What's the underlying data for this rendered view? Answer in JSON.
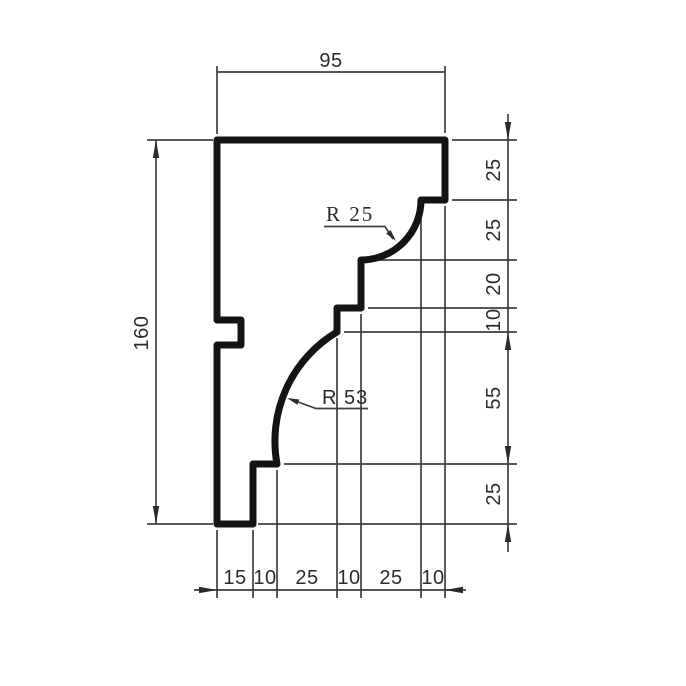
{
  "drawing": {
    "top_width": "95",
    "left_height": "160",
    "right_chain": [
      "25",
      "25",
      "20",
      "10",
      "55",
      "25"
    ],
    "bottom_chain": [
      "15",
      "10",
      "25",
      "10",
      "25",
      "10"
    ],
    "radius_upper": "R 25",
    "radius_lower": "R 53"
  },
  "colors": {
    "background": "#ffffff",
    "profile": "#141414",
    "lines": "#3f3f3f",
    "arrows": "#2b2b2b",
    "text": "#2b2b2b"
  }
}
